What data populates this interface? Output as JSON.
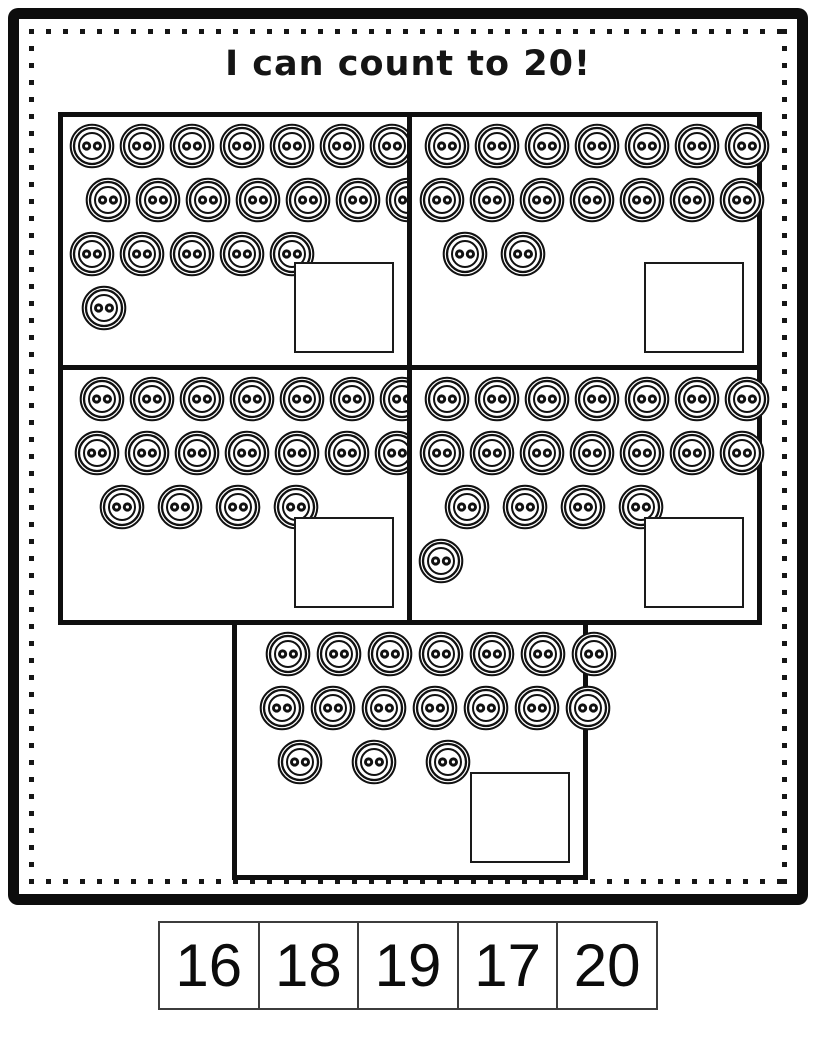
{
  "title": "I can count to 20!",
  "colors": {
    "ink": "#111111",
    "paper": "#ffffff"
  },
  "icons": {
    "button": "two-hole-button-icon"
  },
  "boxes": [
    {
      "name": "top-left",
      "total_buttons": 20,
      "answer": "",
      "rows": [
        {
          "count": 7,
          "indent": 2,
          "gap": 4
        },
        {
          "count": 7,
          "indent": 18,
          "gap": 4
        },
        {
          "count": 5,
          "indent": 2,
          "gap": 4
        },
        {
          "count": 1,
          "indent": 14,
          "gap": 4
        }
      ]
    },
    {
      "name": "top-right",
      "total_buttons": 16,
      "answer": "",
      "rows": [
        {
          "count": 7,
          "indent": 8,
          "gap": 4
        },
        {
          "count": 7,
          "indent": 3,
          "gap": 4
        },
        {
          "count": 2,
          "indent": 26,
          "gap": 12
        }
      ]
    },
    {
      "name": "middle-left",
      "total_buttons": 18,
      "answer": "",
      "rows": [
        {
          "count": 7,
          "indent": 12,
          "gap": 4
        },
        {
          "count": 7,
          "indent": 7,
          "gap": 4
        },
        {
          "count": 4,
          "indent": 32,
          "gap": 12
        }
      ]
    },
    {
      "name": "middle-right",
      "total_buttons": 19,
      "answer": "",
      "rows": [
        {
          "count": 7,
          "indent": 8,
          "gap": 4
        },
        {
          "count": 7,
          "indent": 3,
          "gap": 4
        },
        {
          "count": 4,
          "indent": 28,
          "gap": 12
        },
        {
          "count": 1,
          "indent": 2,
          "gap": 4
        }
      ]
    },
    {
      "name": "bottom-center",
      "total_buttons": 17,
      "answer": "",
      "rows": [
        {
          "count": 7,
          "indent": 24,
          "gap": 5
        },
        {
          "count": 7,
          "indent": 18,
          "gap": 5
        },
        {
          "count": 3,
          "indent": 36,
          "gap": 28
        }
      ]
    }
  ],
  "tiles": [
    "16",
    "18",
    "19",
    "17",
    "20"
  ]
}
